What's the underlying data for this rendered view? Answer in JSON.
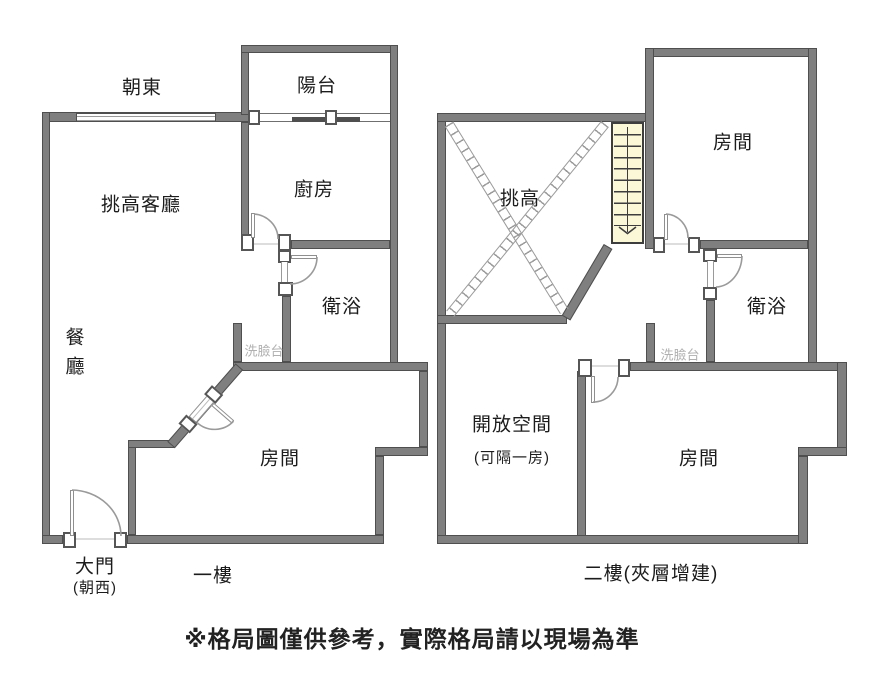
{
  "floor1": {
    "caption": "一樓",
    "orientation": "朝東",
    "labels": {
      "balcony": "陽台",
      "kitchen": "廚房",
      "living": "挑高客廳",
      "bath": "衛浴",
      "washbasin": "洗臉台",
      "dining": "餐廳",
      "bedroom": "房間",
      "main_door": "大門",
      "main_door_facing": "(朝西)"
    }
  },
  "floor2": {
    "caption": "二樓(夾層增建)",
    "labels": {
      "void": "挑高",
      "bedroom_top": "房間",
      "bath": "衛浴",
      "washbasin": "洗臉台",
      "open_space": "開放空間",
      "open_space_note": "(可隔一房)",
      "bedroom": "房間"
    }
  },
  "disclaimer": "※格局圖僅供參考，實際格局請以現場為準",
  "colors": {
    "wall": "#7f7f7f",
    "wall_edge": "#4f4f4f",
    "stairs_fill": "#fbf8d8",
    "door_line": "#9a9a9a",
    "light_text": "#b0b0b0",
    "text": "#1c1c1c"
  }
}
